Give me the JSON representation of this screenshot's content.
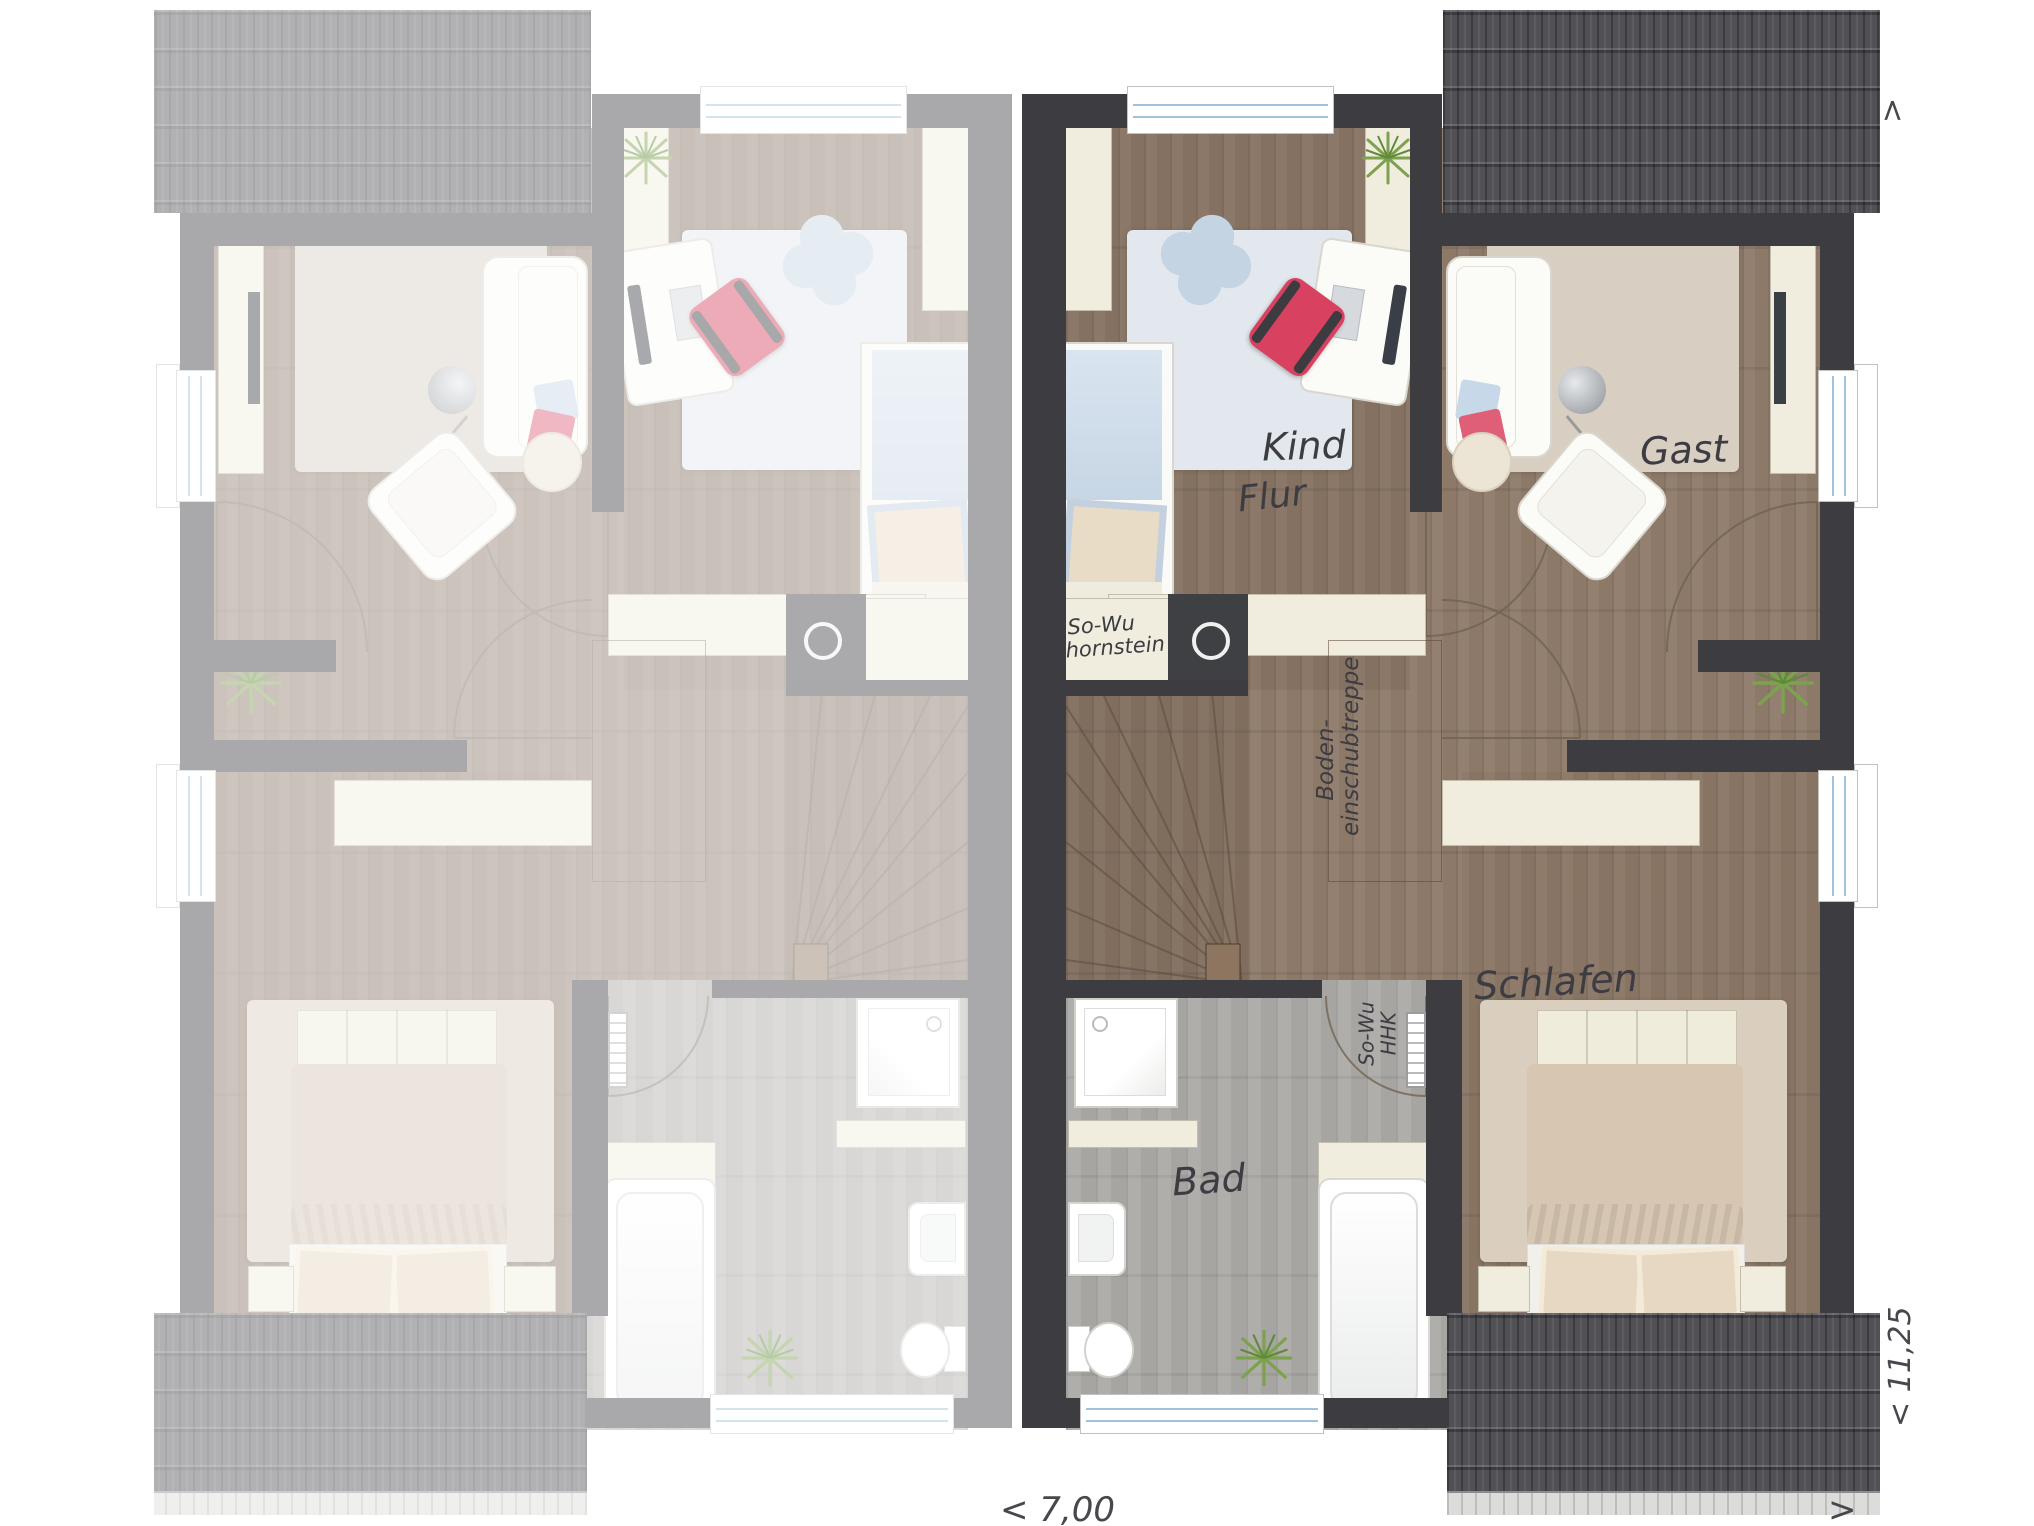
{
  "plan": {
    "rooms": {
      "kind": "Kind",
      "gast": "Gast",
      "flur": "Flur",
      "schlafen": "Schlafen",
      "bad": "Bad"
    },
    "annotations": {
      "chimney": {
        "line1": "So-Wu",
        "line2": "Schornstein"
      },
      "heater": {
        "line1": "So-Wu",
        "line2": "HHK"
      },
      "attic_stairs": {
        "line1": "Boden-",
        "line2": "einschubtreppe"
      }
    },
    "dimensions": {
      "width": "< 7,00",
      "depth": "< 11,25",
      "arrow": ">"
    }
  },
  "colors": {
    "wall": "#3d3d41",
    "wood_floor": "#8d7968",
    "bath_floor": "#a7a5a1",
    "furniture_cream": "#f0edde",
    "bedding_blue": "#c7d6e5",
    "chair_red": "#d8415f",
    "roof_dark": "#505055",
    "plant_green": "#7da24e",
    "window_glass_blue": "#9fc3da"
  }
}
